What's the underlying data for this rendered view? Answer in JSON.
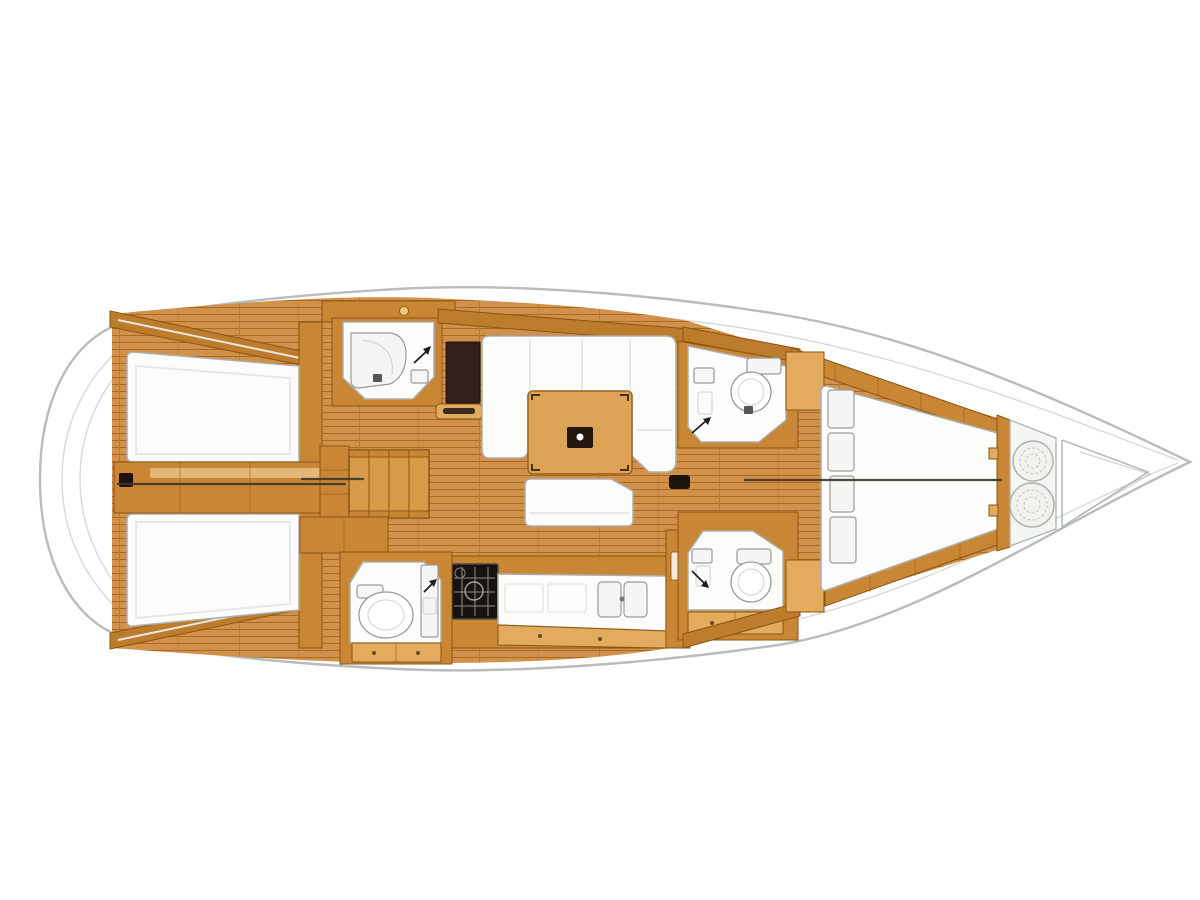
{
  "canvas": {
    "width": 1200,
    "height": 900
  },
  "diagram": {
    "type": "sailing-yacht-interior-deck-plan",
    "orientation": "bow-right-stern-left",
    "areas": [
      "swim-platform",
      "aft-cabin-port",
      "aft-cabin-starboard",
      "engine-compartment",
      "aft-head-port",
      "aft-head-starboard",
      "companionway-steps",
      "nav-station",
      "salon-settee",
      "salon-table",
      "salon-bench",
      "galley-stove",
      "galley-counter-sinks",
      "forward-head-port",
      "forward-head-starboard",
      "forward-cabin-v-berth",
      "forward-shelf-steps",
      "anchor-locker-rope-coils",
      "bow-tip"
    ]
  },
  "palette": {
    "hull-fill": "#ffffff",
    "hull-stroke": "#b7bcbe",
    "deck-line": "#d6dadb",
    "floor-base": "#d2914a",
    "floor-line": "#a96d22",
    "floor-seam": "#b87c2e",
    "wood-mid": "#c98736",
    "wood-light": "#e3ab5e",
    "wood-edge": "#8a5512",
    "wall-dark": "#bd7c2b",
    "table-wood": "#dda356",
    "steps-wood": "#d79a48",
    "dark-fixture": "#32201d",
    "stove-dark": "#17130f",
    "hatch-dark": "#1c130d",
    "white-furn": "#fcfcfb",
    "furn-stroke": "#adadaa",
    "seam-light": "#e7e7e3",
    "fixture-stroke": "#9a9a97",
    "centerline": "#3f362b",
    "bow-line": "#aeb2b4",
    "bow-fill": "#f5f5f3",
    "knob": "#e9c97f"
  }
}
